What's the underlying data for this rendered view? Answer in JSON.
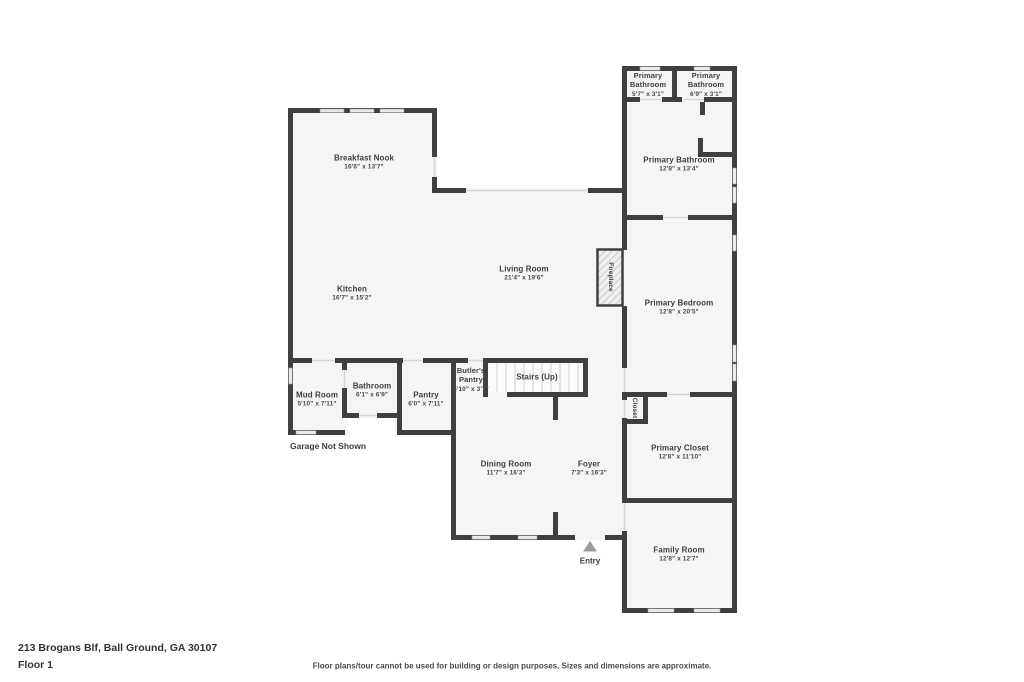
{
  "colors": {
    "wall": "#3f3f3f",
    "floor": "#f5f5f5",
    "window": "#eaeaea",
    "opening": "#d6d6d6",
    "text": "#3d3d3d",
    "page_bg": "#ffffff"
  },
  "rooms": {
    "breakfast_nook": {
      "name": "Breakfast Nook",
      "dims": "16'6\" x 13'7\""
    },
    "kitchen": {
      "name": "Kitchen",
      "dims": "16'7\" x 15'2\""
    },
    "living_room": {
      "name": "Living Room",
      "dims": "21'4\" x 19'6\""
    },
    "primary_bathroom_1": {
      "name": "Primary Bathroom",
      "dims": "5'7\" x 3'1\""
    },
    "primary_bathroom_2": {
      "name": "Primary Bathroom",
      "dims": "6'9\" x 3'1\""
    },
    "primary_bathroom": {
      "name": "Primary Bathroom",
      "dims": "12'8\" x 13'4\""
    },
    "primary_bedroom": {
      "name": "Primary Bedroom",
      "dims": "12'8\" x 20'5\""
    },
    "mud_room": {
      "name": "Mud Room",
      "dims": "5'10\" x 7'11\""
    },
    "bathroom": {
      "name": "Bathroom",
      "dims": "6'1\" x 6'9\""
    },
    "pantry": {
      "name": "Pantry",
      "dims": "6'0\" x 7'11\""
    },
    "butlers_pantry": {
      "name": "Butler's Pantry",
      "dims": "5'10\" x 3'7\""
    },
    "stairs": {
      "name": "Stairs (Up)"
    },
    "dining_room": {
      "name": "Dining Room",
      "dims": "11'7\" x 16'3\""
    },
    "foyer": {
      "name": "Foyer",
      "dims": "7'3\" x 16'3\""
    },
    "primary_closet": {
      "name": "Primary Closet",
      "dims": "12'8\" x 11'10\""
    },
    "family_room": {
      "name": "Family Room",
      "dims": "12'8\" x 12'7\""
    },
    "closet": {
      "name": "Closet"
    },
    "fireplace": {
      "name": "Fireplace"
    }
  },
  "annotations": {
    "garage_note": "Garage Not Shown",
    "entry_label": "Entry"
  },
  "footer": {
    "address": "213 Brogans Blf, Ball Ground, GA 30107",
    "floor_label": "Floor 1",
    "disclaimer": "Floor plans/tour cannot be used for building or design purposes. Sizes and dimensions are approximate."
  }
}
